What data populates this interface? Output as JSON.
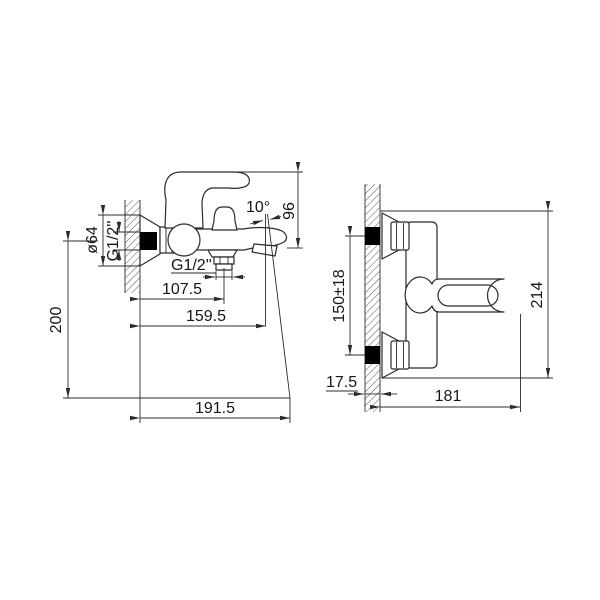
{
  "colors": {
    "background": "#ffffff",
    "line": "#2b2b2b",
    "text": "#161616",
    "wall_fitting": "#000000"
  },
  "side_view": {
    "escutcheon_diameter": "ø64",
    "wall_thread": "G1/2''",
    "spout_angle": "10°",
    "spout_height": "96",
    "outlet_thread": "G1/2''",
    "wall_to_outlet": "107.5",
    "wall_to_spout_end": "159.5",
    "overall_height": "200",
    "overall_depth": "191.5"
  },
  "front_view": {
    "inlet_centers": "150±18",
    "overall_height": "214",
    "wall_thickness": "17.5",
    "overall_width": "181"
  }
}
